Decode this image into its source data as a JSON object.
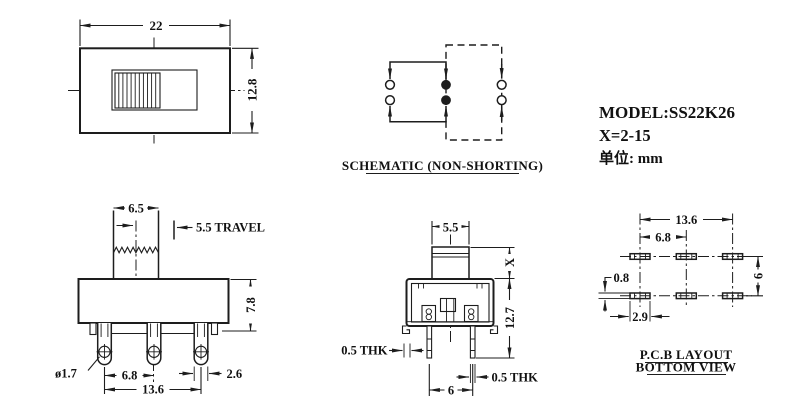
{
  "info": {
    "model": "MODEL:SS22K26",
    "x_range": "X=2-15",
    "units": "单位: mm"
  },
  "captions": {
    "schematic": "SCHEMATIC (NON-SHORTING)",
    "pcb_line1": "P.C.B LAYOUT",
    "pcb_line2": "BOTTOM VIEW"
  },
  "top_view": {
    "width": "22",
    "height": "12.8"
  },
  "front_view": {
    "knob_width": "6.5",
    "travel": "5.5 TRAVEL",
    "body_height": "7.8",
    "hole_diameter": "ø1.7",
    "pin_pitch": "6.8",
    "pin_span": "13.6",
    "terminal_width": "2.6"
  },
  "side_view": {
    "knob_depth": "5.5",
    "stem_height": "X",
    "height_below_stem": "12.7",
    "cover_thickness": "0.5 THK",
    "pin_thickness": "0.5 THK",
    "pin_pitch": "6"
  },
  "pcb_view": {
    "span": "13.6",
    "pitch": "6.8",
    "row_pitch": "6",
    "pad_height": "0.8",
    "pad_width": "2.9"
  }
}
